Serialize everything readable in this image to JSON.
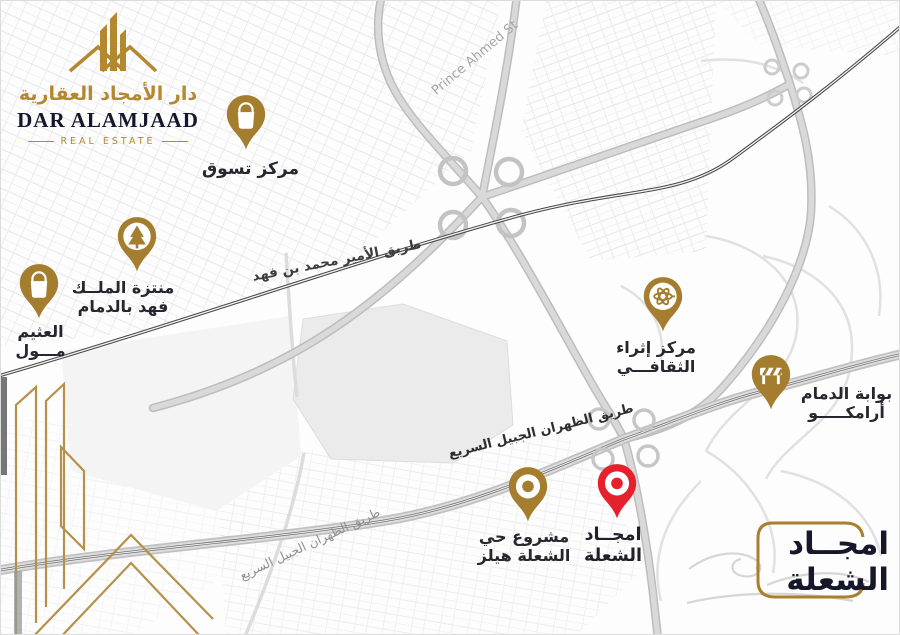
{
  "brand": {
    "title_ar": "دار الأمجاد العقارية",
    "title_en": "DAR ALAMJAAD",
    "subtitle_en": "REAL ESTATE"
  },
  "footer_logo": {
    "line1": "امجــاد",
    "line2": "الشعلة"
  },
  "colors": {
    "gold": "#a57d2e",
    "gold_line": "#b5914a",
    "red": "#e5212e",
    "navy": "#17172b",
    "road_dark": "#474747"
  },
  "map": {
    "road_labels": [
      {
        "id": "prince-ahmed-st",
        "text": "Prince Ahmed St"
      },
      {
        "id": "prince-mohammed-bin-fahd-rd",
        "text": "طريق الأمير محمد بن فهد"
      },
      {
        "id": "dhahran-jubail-expressway-1",
        "text": "طريق الظهران الجبيل السريع"
      },
      {
        "id": "dhahran-jubail-expressway-2",
        "text": "طريق الظهران الجبيل السريع"
      }
    ],
    "pins": [
      {
        "id": "shopping-center",
        "icon": "shopping-bag-icon",
        "color": "#a57d2e",
        "lines": [
          "مركز تسوق"
        ]
      },
      {
        "id": "king-fahd-park",
        "icon": "tree-icon",
        "color": "#a57d2e",
        "lines": [
          "منتزة الملــك",
          "فهد بالدمام"
        ]
      },
      {
        "id": "othaim-mall",
        "icon": "shopping-bag-icon",
        "color": "#a57d2e",
        "lines": [
          "العثيم",
          "مـــول"
        ]
      },
      {
        "id": "ithra-cultural-center",
        "icon": "ithra-icon",
        "color": "#a57d2e",
        "lines": [
          "مركز إثراء",
          "الثقافـــي"
        ]
      },
      {
        "id": "aramco-dammam-gate",
        "icon": "barrier-icon",
        "color": "#a57d2e",
        "lines": [
          "بوابة الدمام",
          "أرامكـــــو"
        ]
      },
      {
        "id": "shoala-hills-project",
        "icon": "ring-icon",
        "color": "#a57d2e",
        "lines": [
          "مشروع حي",
          "الشعلة هيلز"
        ]
      },
      {
        "id": "amjad-alshoala",
        "icon": "ring-icon",
        "color": "#e5212e",
        "lines": [
          "امجــاد",
          "الشعلة"
        ]
      }
    ]
  }
}
